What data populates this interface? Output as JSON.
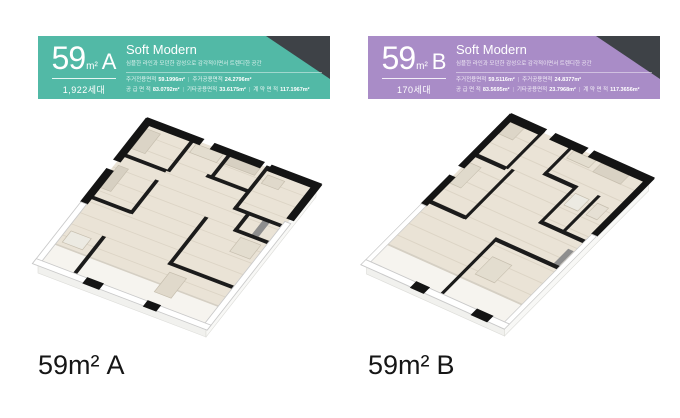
{
  "cards": [
    {
      "variant": "A",
      "accent_color": "#52b9a6",
      "corner_color": "#3e4247",
      "area_number": "59",
      "area_unit": "m²",
      "type_letter": "A",
      "units_count": "1,922세대",
      "style_title": "Soft Modern",
      "style_subtitle": "심플한 라인과 모던한 감성으로 감각적이면서 트렌디한 공간",
      "separator": "|",
      "stats_row1": [
        {
          "label": "주거전용면적",
          "value": "59.1996m²"
        },
        {
          "label": "주거공용면적",
          "value": "24.2796m²"
        }
      ],
      "stats_row2": [
        {
          "label": "공 급 면 적",
          "value": "83.0792m²"
        },
        {
          "label": "기타공용면적",
          "value": "33.6175m²"
        },
        {
          "label": "계 약 면 적",
          "value": "117.1967m²"
        }
      ],
      "caption": {
        "number": "59",
        "unit": "m²",
        "letter": "A"
      }
    },
    {
      "variant": "B",
      "accent_color": "#a98cc7",
      "corner_color": "#3e4247",
      "area_number": "59",
      "area_unit": "m²",
      "type_letter": "B",
      "units_count": "170세대",
      "style_title": "Soft Modern",
      "style_subtitle": "심플한 라인과 모던한 감성으로 감각적이면서 트렌디한 공간",
      "separator": "|",
      "stats_row1": [
        {
          "label": "주거전용면적",
          "value": "59.5116m²"
        },
        {
          "label": "주거공용면적",
          "value": "24.8377m²"
        }
      ],
      "stats_row2": [
        {
          "label": "공 급 면 적",
          "value": "83.5695m²"
        },
        {
          "label": "기타공용면적",
          "value": "23.7968m²"
        },
        {
          "label": "계 약 면 적",
          "value": "117.3656m²"
        }
      ],
      "caption": {
        "number": "59",
        "unit": "m²",
        "letter": "B"
      }
    }
  ]
}
